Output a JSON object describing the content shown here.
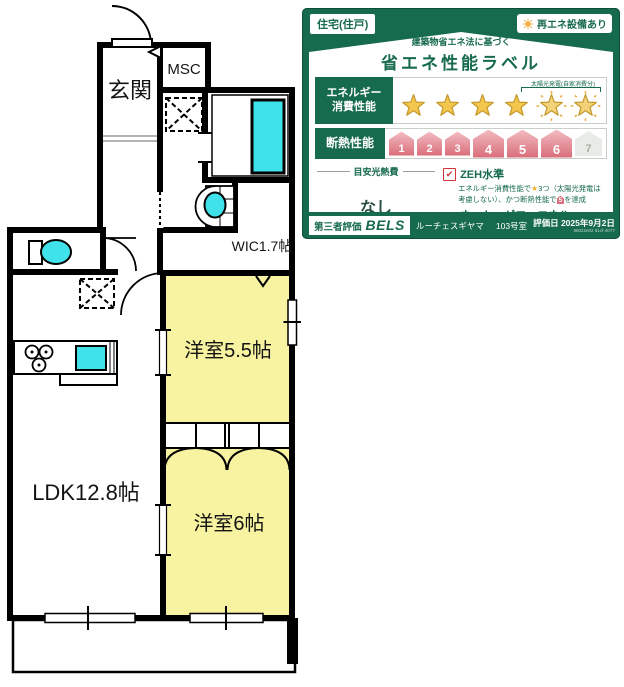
{
  "floorplan": {
    "rooms": {
      "entrance": "玄関",
      "msc": "MSC",
      "wic": "WIC1.7帖",
      "bedroom1": "洋室5.5帖",
      "ldk": "LDK12.8帖",
      "bedroom2": "洋室6帖"
    },
    "colors": {
      "room_yellow": "#f8f3a1",
      "fixture_cyan": "#3fe1ea",
      "wall": "#000000"
    }
  },
  "label": {
    "colors": {
      "green": "#166a4d",
      "star_gold": "#f5c64d",
      "house_pink": "#d96d79",
      "house_inactive": "#e9ebe6",
      "check_red": "#cf3535"
    },
    "top_left_badge": "住宅(住戸)",
    "top_right_badge": "再エネ設備あり",
    "subtitle": "建築物省エネ法に基づく",
    "title": "省エネ性能ラベル",
    "energy_row": {
      "label_line1": "エネルギー",
      "label_line2": "消費性能",
      "stars_total": 6,
      "stars_solar": 2,
      "solar_note": "太陽光発電(自家消費分)"
    },
    "insulation_row": {
      "label": "断熱性能",
      "levels": [
        "1",
        "2",
        "3",
        "4",
        "5",
        "6",
        "7"
      ],
      "achieved": 6
    },
    "cost": {
      "heading": "目安光熱費",
      "value": "なし"
    },
    "zeh": {
      "title": "ZEH水準",
      "desc_1": "エネルギー消費性能で",
      "desc_star": "★",
      "desc_2": "3つ（太陽光発電",
      "desc_3": "は考慮しない）、かつ断熱性能で",
      "desc_badge": "5",
      "desc_4": "を達成"
    },
    "nze": {
      "title": "ネット・ゼロ・エネルギー",
      "icon": "ZEH",
      "desc": "太陽光発電の売電分も含めてエネルギー収支がゼロ以下を達成"
    },
    "footer": {
      "cert_label": "第三者評価",
      "cert_brand": "BELS",
      "building": "ルーチェスギヤマ",
      "unit": "103号室",
      "date_label": "評価日",
      "date": "2025年9月2日",
      "code": "96022e02 61cf-4077"
    }
  }
}
